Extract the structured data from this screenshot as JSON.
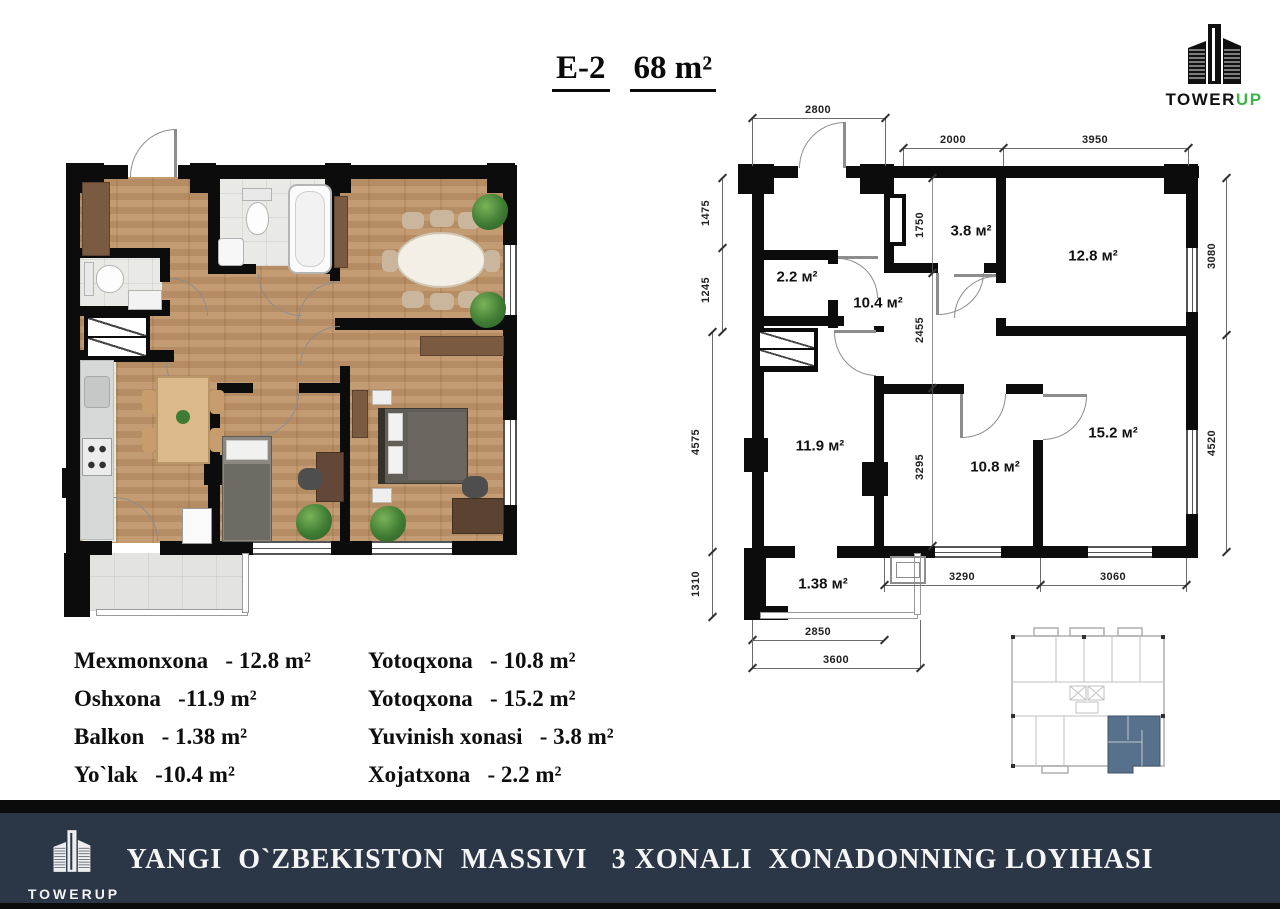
{
  "title": {
    "code": "E-2",
    "area": "68 m²"
  },
  "top_logo": {
    "tower": "TOWER",
    "up": "UP"
  },
  "banner": {
    "text": "YANGI  O`ZBEKISTON  MASSIVI   3 XONALI  XONADONNING LOYIHASI",
    "logo_text": "TOWERUP"
  },
  "plan": {
    "rooms": [
      {
        "name": "xojatxona",
        "label": "2.2 м²"
      },
      {
        "name": "yolak",
        "label": "10.4 м²"
      },
      {
        "name": "yuvinish-xonasi",
        "label": "3.8 м²"
      },
      {
        "name": "mexmonxona",
        "label": "12.8 м²"
      },
      {
        "name": "oshxona",
        "label": "11.9 м²"
      },
      {
        "name": "yotoqxona-1",
        "label": "10.8 м²"
      },
      {
        "name": "yotoqxona-2",
        "label": "15.2 м²"
      },
      {
        "name": "balkon",
        "label": "1.38 м²"
      }
    ],
    "dims": {
      "top": [
        "2800",
        "2000",
        "3950"
      ],
      "left": [
        "1475",
        "1245",
        "4575",
        "1310"
      ],
      "right": [
        "3080",
        "4520"
      ],
      "inner": [
        "1750",
        "2455",
        "3295"
      ],
      "bottom": [
        "3290",
        "3060"
      ],
      "balcony": [
        "2850",
        "3600"
      ]
    }
  },
  "legend": {
    "left": [
      "Mexmonxona   - 12.8 m²",
      "Oshxona   -11.9 m²",
      "Balkon   - 1.38 m²",
      "Yo`lak   -10.4 m²"
    ],
    "right": [
      "Yotoqxona   - 10.8 m²",
      "Yotoqxona   - 15.2 m²",
      "Yuvinish xonasi   - 3.8 m²",
      "Xojatxona   - 2.2 m²"
    ]
  },
  "colors": {
    "accent_green": "#3cb44a",
    "banner_bg": "#2b3747",
    "unit_highlight": "#57718c",
    "wood": "#bf9468"
  }
}
